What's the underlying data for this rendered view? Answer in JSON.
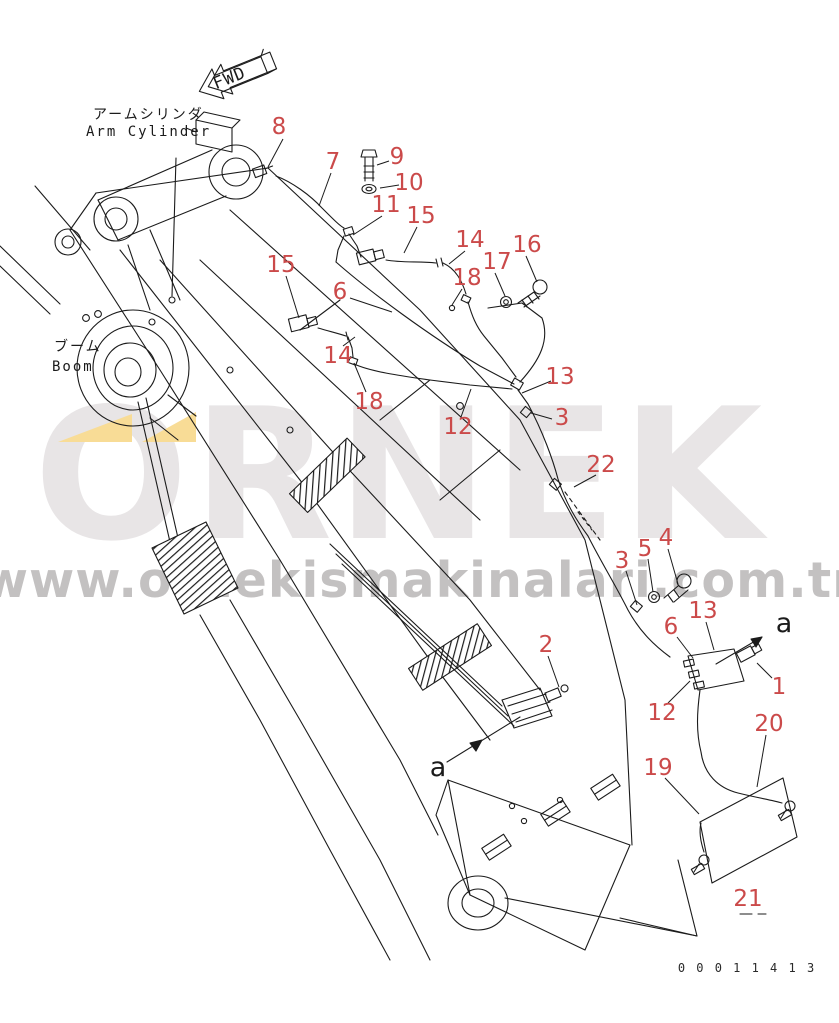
{
  "meta": {
    "background": "#ffffff",
    "line_color": "#1b1b1b",
    "callout_color": "#cb4a4a",
    "callout_font_size": 23,
    "ref_letter_color": "#1b1b1b",
    "ref_letter_font_size": 27
  },
  "labels": {
    "fwd": "FWD",
    "arm_cylinder_jp": "アームシリンダ",
    "arm_cylinder_en": "Arm Cylinder",
    "boom_jp": "ブーム",
    "boom_en": "Boom",
    "drawing_number": "0 0 0 1 1 4 1 3"
  },
  "watermark": {
    "brand": "ORNEK",
    "url": "www.ornekismakinalari.com.tr",
    "brand_color": "#e8e5e6",
    "url_color": "#c3c1c1",
    "accent_color": "#f8dc96"
  },
  "callouts": [
    {
      "label": "8",
      "x": 279,
      "y": 126,
      "leader": [
        283,
        139,
        268,
        167
      ]
    },
    {
      "label": "7",
      "x": 333,
      "y": 161,
      "leader": [
        331,
        173,
        319,
        206
      ]
    },
    {
      "label": "9",
      "x": 397,
      "y": 156,
      "leader": [
        389,
        161,
        377,
        165
      ]
    },
    {
      "label": "10",
      "x": 409,
      "y": 182,
      "leader": [
        399,
        185,
        380,
        188
      ]
    },
    {
      "label": "11",
      "x": 386,
      "y": 204,
      "leader": [
        382,
        216,
        353,
        235
      ]
    },
    {
      "label": "15",
      "x": 421,
      "y": 215,
      "leader": [
        417,
        227,
        404,
        253
      ]
    },
    {
      "label": "14",
      "x": 470,
      "y": 239,
      "leader": [
        465,
        251,
        449,
        264
      ]
    },
    {
      "label": "16",
      "x": 527,
      "y": 244,
      "leader": [
        526,
        256,
        537,
        282
      ]
    },
    {
      "label": "17",
      "x": 497,
      "y": 261,
      "leader": [
        495,
        273,
        505,
        296
      ]
    },
    {
      "label": "18",
      "x": 467,
      "y": 277,
      "leader": [
        462,
        289,
        452,
        305
      ]
    },
    {
      "label": "15",
      "x": 281,
      "y": 264,
      "leader": [
        286,
        276,
        299,
        318
      ]
    },
    {
      "label": "6",
      "x": 340,
      "y": 291,
      "leader": [
        350,
        298,
        392,
        312
      ]
    },
    {
      "label": "14",
      "x": 338,
      "y": 355,
      "leader": [
        343,
        346,
        355,
        337
      ]
    },
    {
      "label": "18",
      "x": 369,
      "y": 401,
      "leader": [
        366,
        392,
        354,
        363
      ]
    },
    {
      "label": "12",
      "x": 458,
      "y": 426,
      "leader": [
        461,
        417,
        471,
        389
      ]
    },
    {
      "label": "13",
      "x": 560,
      "y": 376,
      "leader": [
        551,
        381,
        522,
        393
      ]
    },
    {
      "label": "3",
      "x": 562,
      "y": 417,
      "leader": [
        552,
        419,
        531,
        413
      ]
    },
    {
      "label": "22",
      "x": 601,
      "y": 464,
      "leader": [
        596,
        475,
        574,
        487
      ]
    },
    {
      "label": "3",
      "x": 622,
      "y": 560,
      "leader": [
        626,
        571,
        637,
        605
      ]
    },
    {
      "label": "5",
      "x": 645,
      "y": 548,
      "leader": [
        648,
        559,
        653,
        592
      ]
    },
    {
      "label": "4",
      "x": 666,
      "y": 537,
      "leader": [
        668,
        549,
        678,
        584
      ]
    },
    {
      "label": "13",
      "x": 703,
      "y": 610,
      "leader": [
        706,
        622,
        714,
        650
      ]
    },
    {
      "label": "6",
      "x": 671,
      "y": 626,
      "leader": [
        677,
        637,
        693,
        658
      ]
    },
    {
      "label": "12",
      "x": 662,
      "y": 712,
      "leader": [
        668,
        703,
        690,
        681
      ]
    },
    {
      "label": "1",
      "x": 779,
      "y": 686,
      "leader": [
        772,
        678,
        757,
        663
      ]
    },
    {
      "label": "2",
      "x": 546,
      "y": 644,
      "leader": [
        548,
        656,
        559,
        687
      ]
    },
    {
      "label": "20",
      "x": 769,
      "y": 723,
      "leader": [
        766,
        735,
        757,
        787
      ]
    },
    {
      "label": "19",
      "x": 658,
      "y": 767,
      "leader": [
        665,
        778,
        699,
        814
      ]
    },
    {
      "label": "21",
      "x": 748,
      "y": 898
    },
    {
      "label": "a",
      "x": 784,
      "y": 624,
      "ref": true
    },
    {
      "label": "a",
      "x": 438,
      "y": 768,
      "ref": true
    }
  ]
}
